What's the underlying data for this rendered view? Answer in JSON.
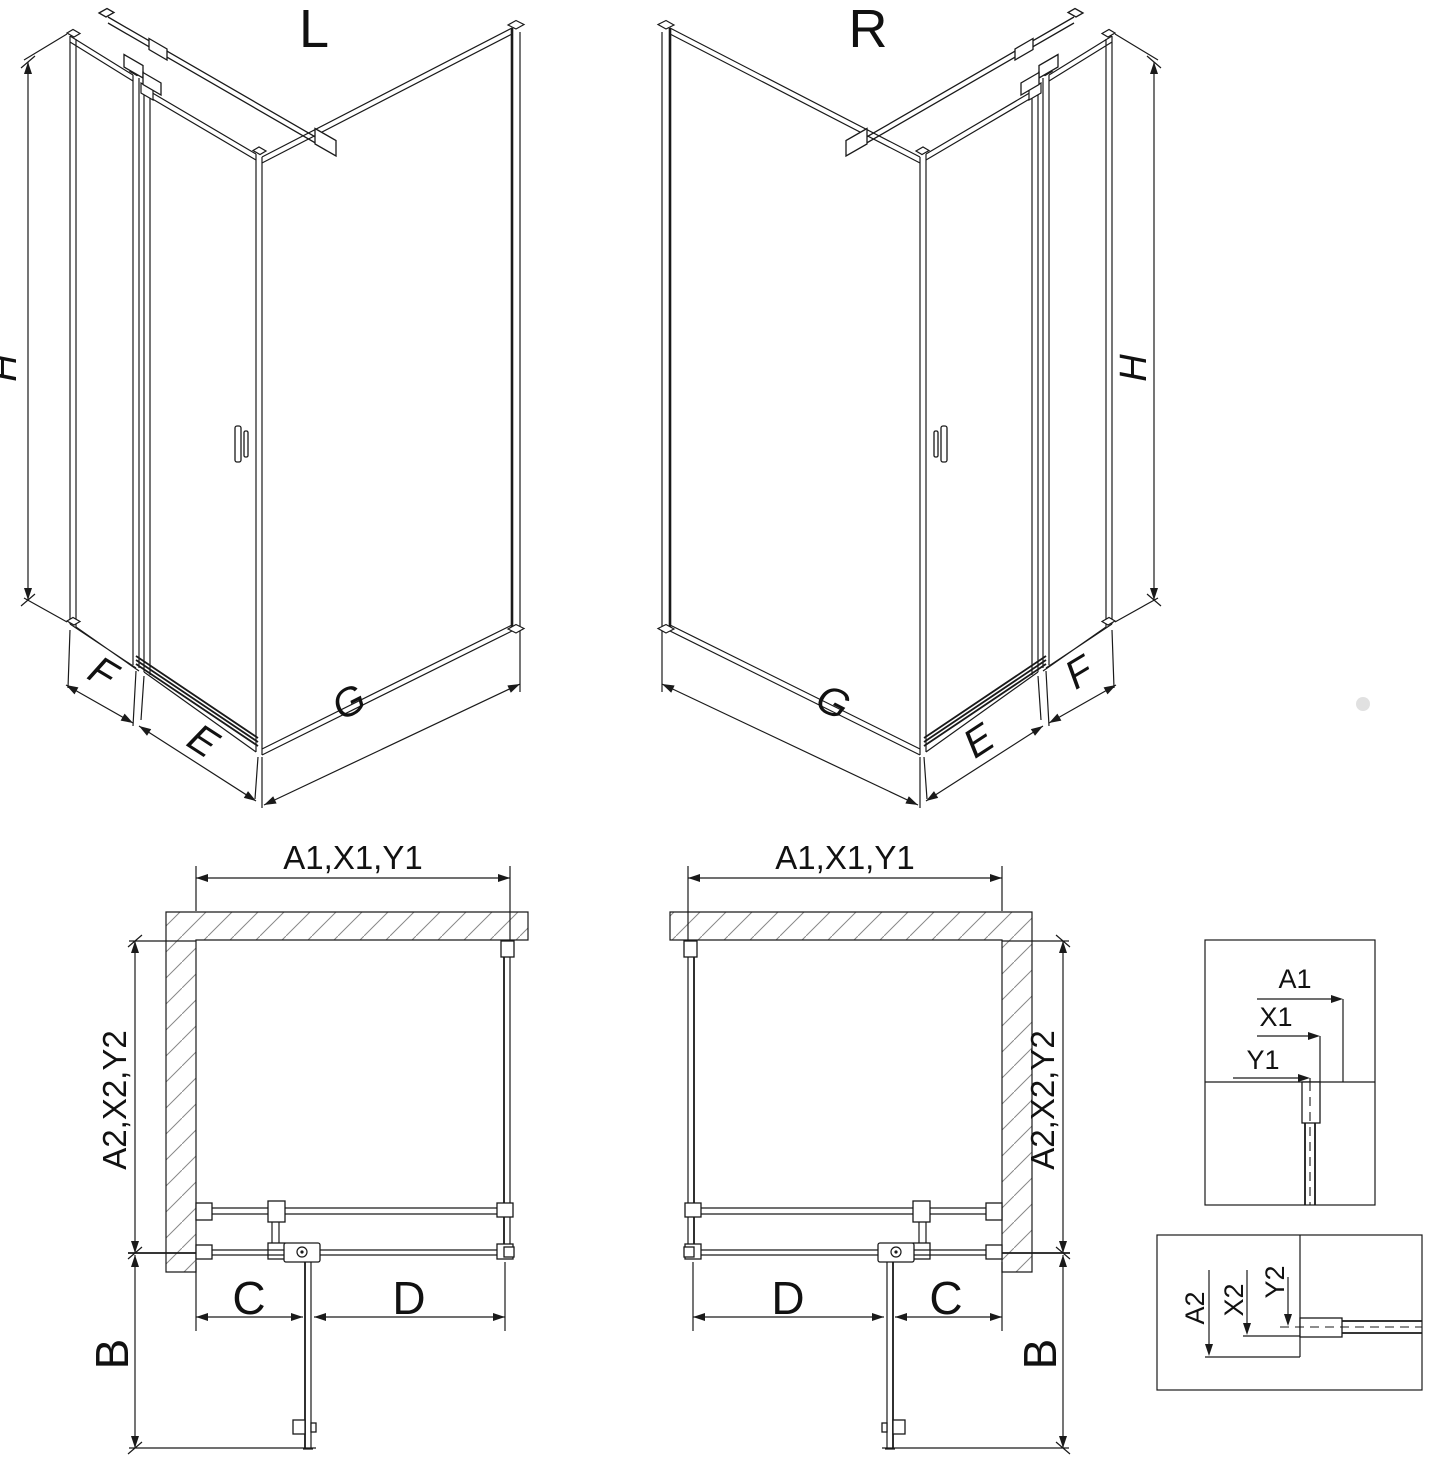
{
  "document": {
    "type": "technical-drawing",
    "subject": "corner shower enclosure with pivot door, left and right versions",
    "background": "#ffffff",
    "line_color": "#1a1a1a",
    "hatch_color": "#888888"
  },
  "iso": {
    "left_title": "L",
    "right_title": "R",
    "height": "H",
    "side_panel": "F",
    "door": "E",
    "return_panel": "G"
  },
  "plan": {
    "width": "A1,X1,Y1",
    "depth": "A2,X2,Y2",
    "fixed": "C",
    "door": "D",
    "projection": "B"
  },
  "details": {
    "a1": "A1",
    "x1": "X1",
    "y1": "Y1",
    "a2": "A2",
    "x2": "X2",
    "y2": "Y2"
  }
}
